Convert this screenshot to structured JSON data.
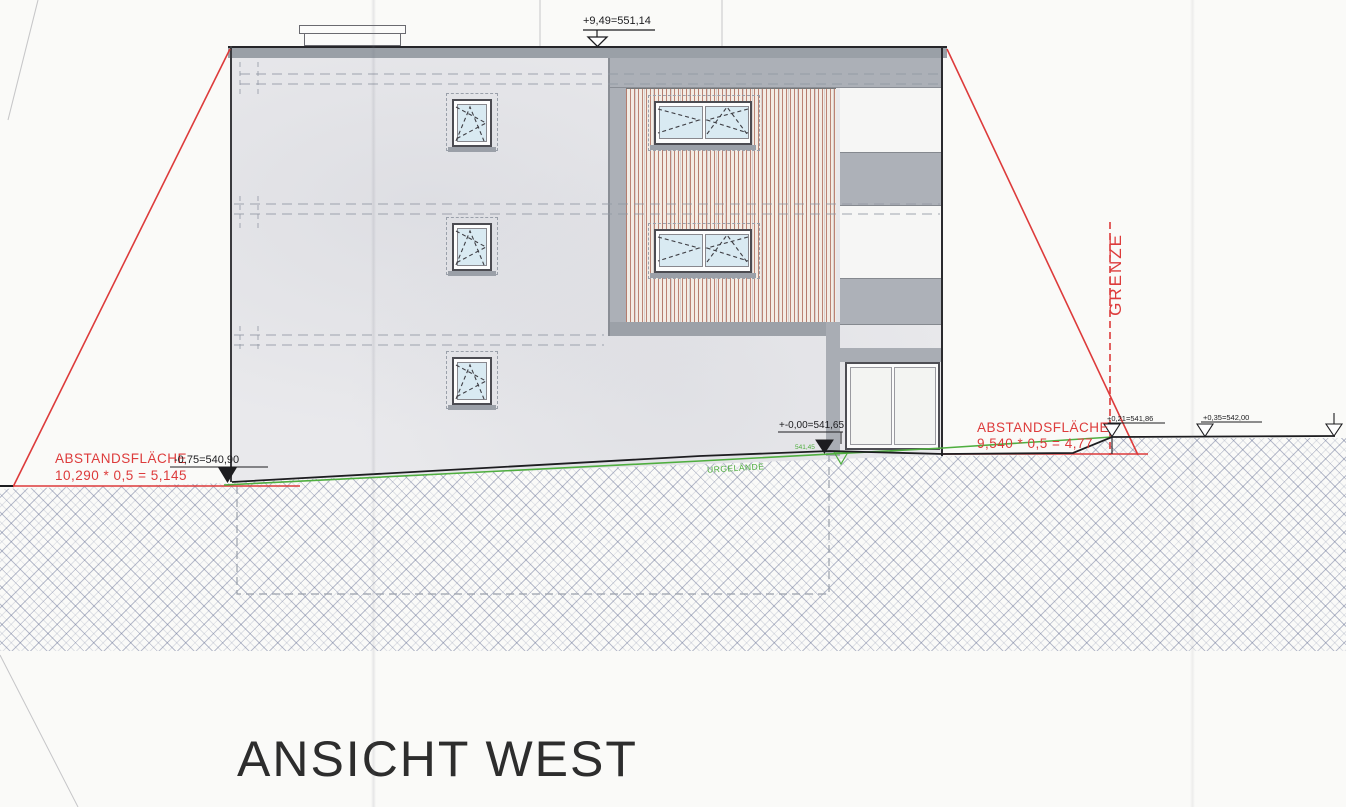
{
  "sheet": {
    "title": "ANSICHT WEST"
  },
  "annotations": {
    "roof_level": "+9,49=551,14",
    "left_setback_label": "ABSTANDSFLÄCHE",
    "left_setback_calc": "10,290 * 0,5 = 5,145",
    "left_ground_level": "-0,75=540,90",
    "zero_level": "+-0,00=541,65",
    "terrain_spot_level": "541,45",
    "right_setback_label": "ABSTANDSFLÄCHE",
    "right_setback_calc": "9,540 * 0,5 = 4,77",
    "boundary_spot_level_1": "+0,21=541,86",
    "boundary_spot_level_2": "+0,35=542,00",
    "boundary_label": "GRENZE",
    "terrain_label": "URGELÄNDE"
  },
  "colors": {
    "annotation_red": "#dd3b3b",
    "terrain_green": "#4fae3f",
    "drawing_black": "#1d1d20",
    "facade_gray": "#abafb6",
    "wood_slat_red": "#a8604e",
    "glass_blue": "#d9eaf2"
  }
}
